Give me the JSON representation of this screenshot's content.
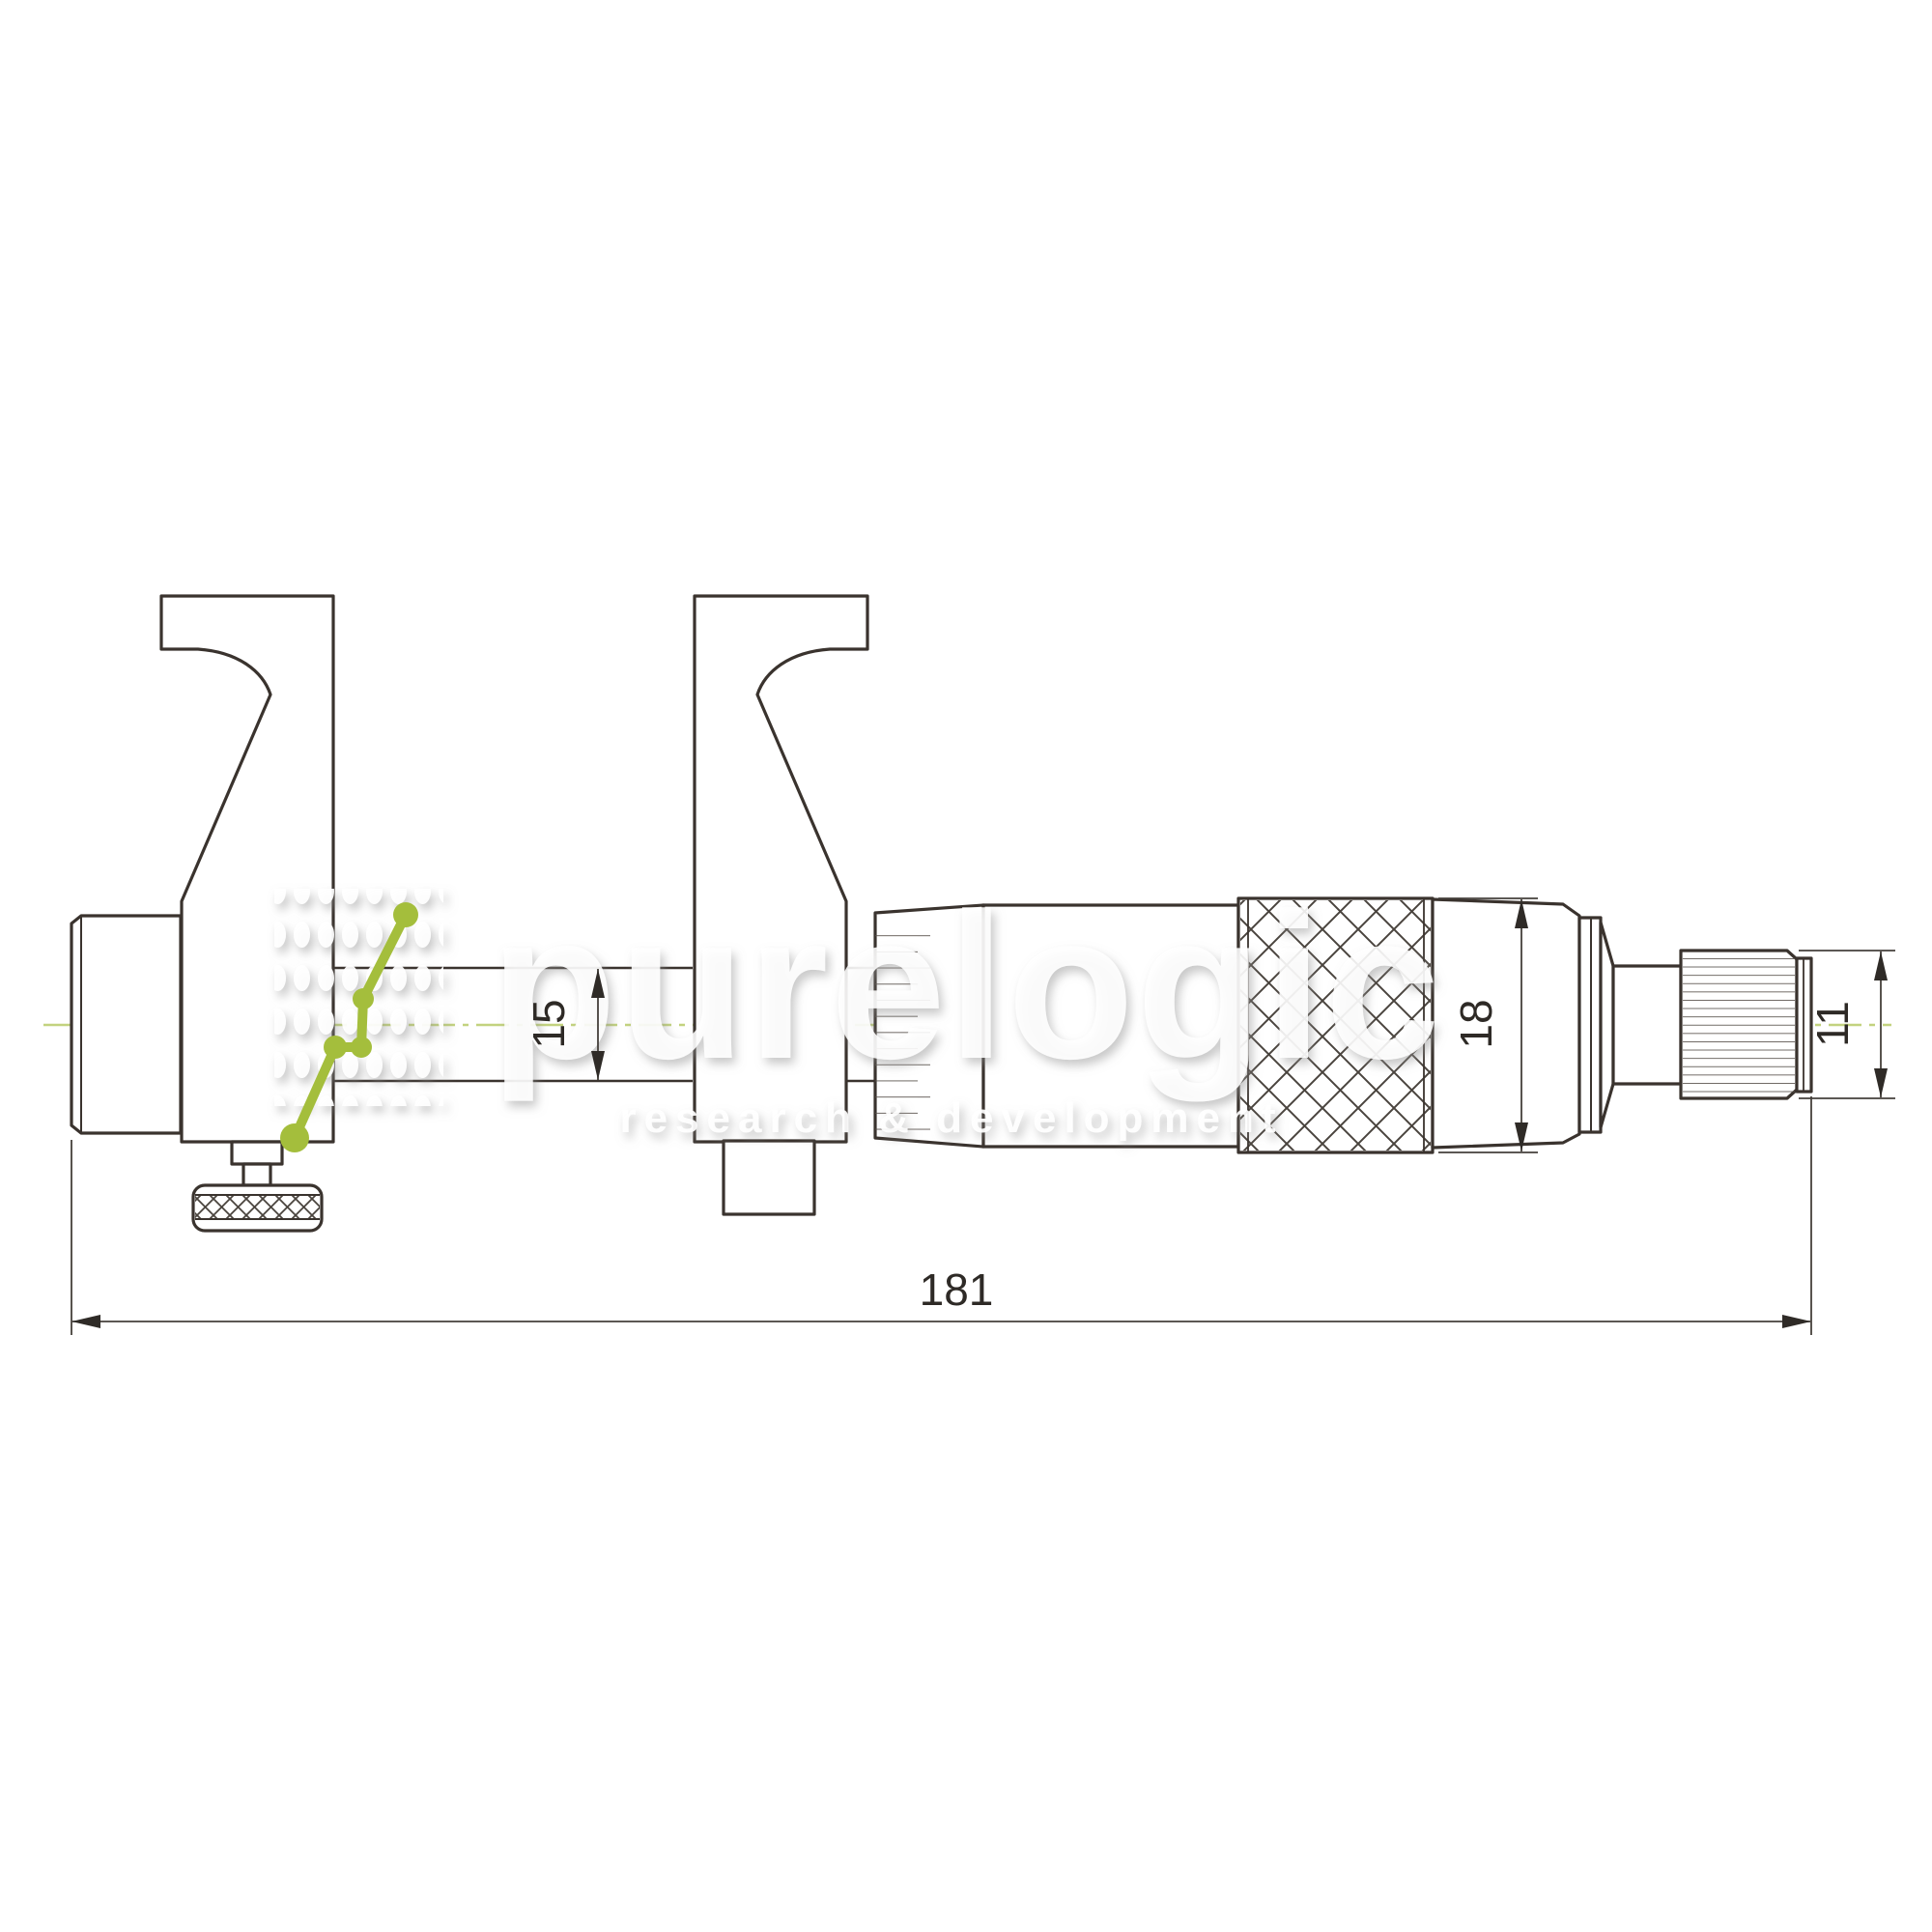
{
  "watermark": {
    "brand": "purelogic",
    "tagline": "research & development",
    "logo_mark": "green-dot-chain-icon",
    "accent_green": "#a4be3c",
    "text_color": "rgba(255,255,255,0.88)"
  },
  "dimensions": {
    "overall_length": "181",
    "spindle_diameter": "15",
    "thimble_diameter": "18",
    "ratchet_diameter": "11"
  },
  "drawing": {
    "subject": "inside micrometer with caliper jaws, side view",
    "outline_color": "#3a332e",
    "thin_line_color": "#57504a",
    "dimension_color": "#45403b",
    "centerline_color": "#c3d37f",
    "background": "#ffffff"
  }
}
